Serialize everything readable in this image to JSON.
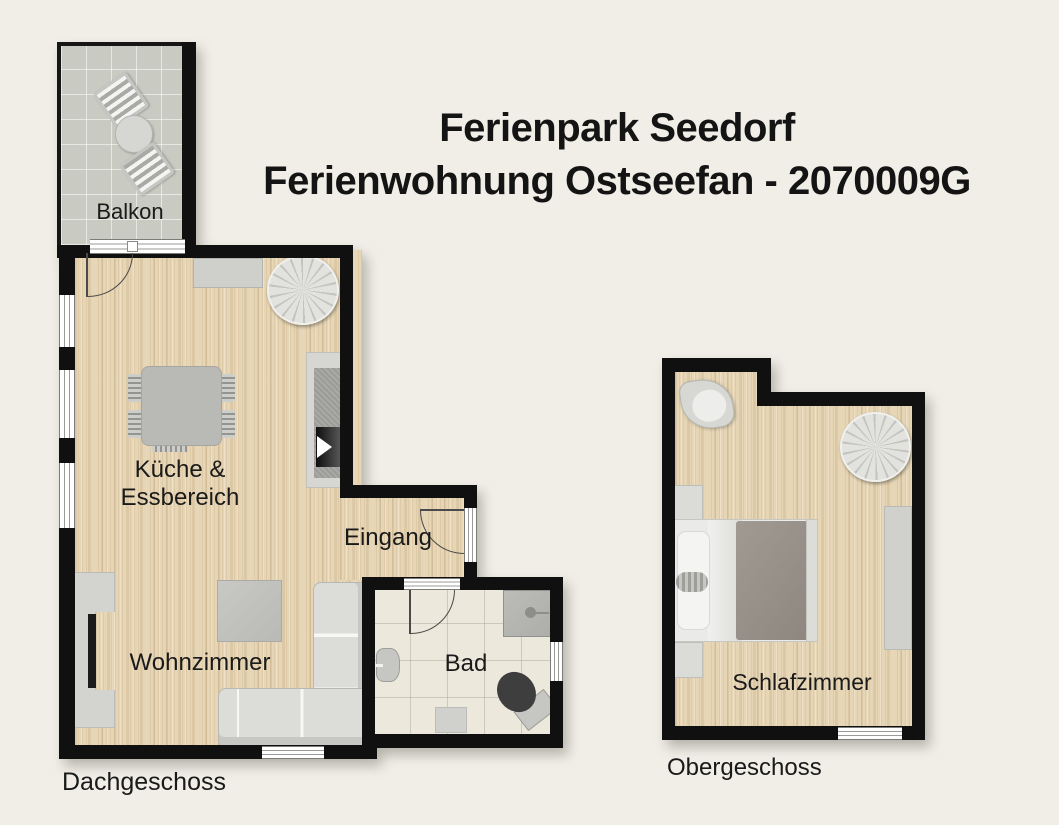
{
  "title": {
    "line1": "Ferienpark Seedorf",
    "line2": "Ferienwohnung Ostseefan - 2070009G"
  },
  "floors": {
    "dachgeschoss": {
      "label": "Dachgeschoss"
    },
    "obergeschoss": {
      "label": "Obergeschoss"
    }
  },
  "labels": {
    "balkon": "Balkon",
    "kueche_line1": "Küche &",
    "kueche_line2": "Essbereich",
    "eingang": "Eingang",
    "wohnzimmer": "Wohnzimmer",
    "bad": "Bad",
    "schlafzimmer": "Schlafzimmer"
  },
  "colors": {
    "bg": "#f0eee7",
    "wall": "#101010",
    "text": "#1a1a1a",
    "wood": "#e6d6b6",
    "balcony_tile": "#c9cac2",
    "bath_tile": "#ece8db",
    "furn": "#d2d2cf",
    "furn_dark": "#a6a6a3",
    "duvet": "#96908a"
  }
}
